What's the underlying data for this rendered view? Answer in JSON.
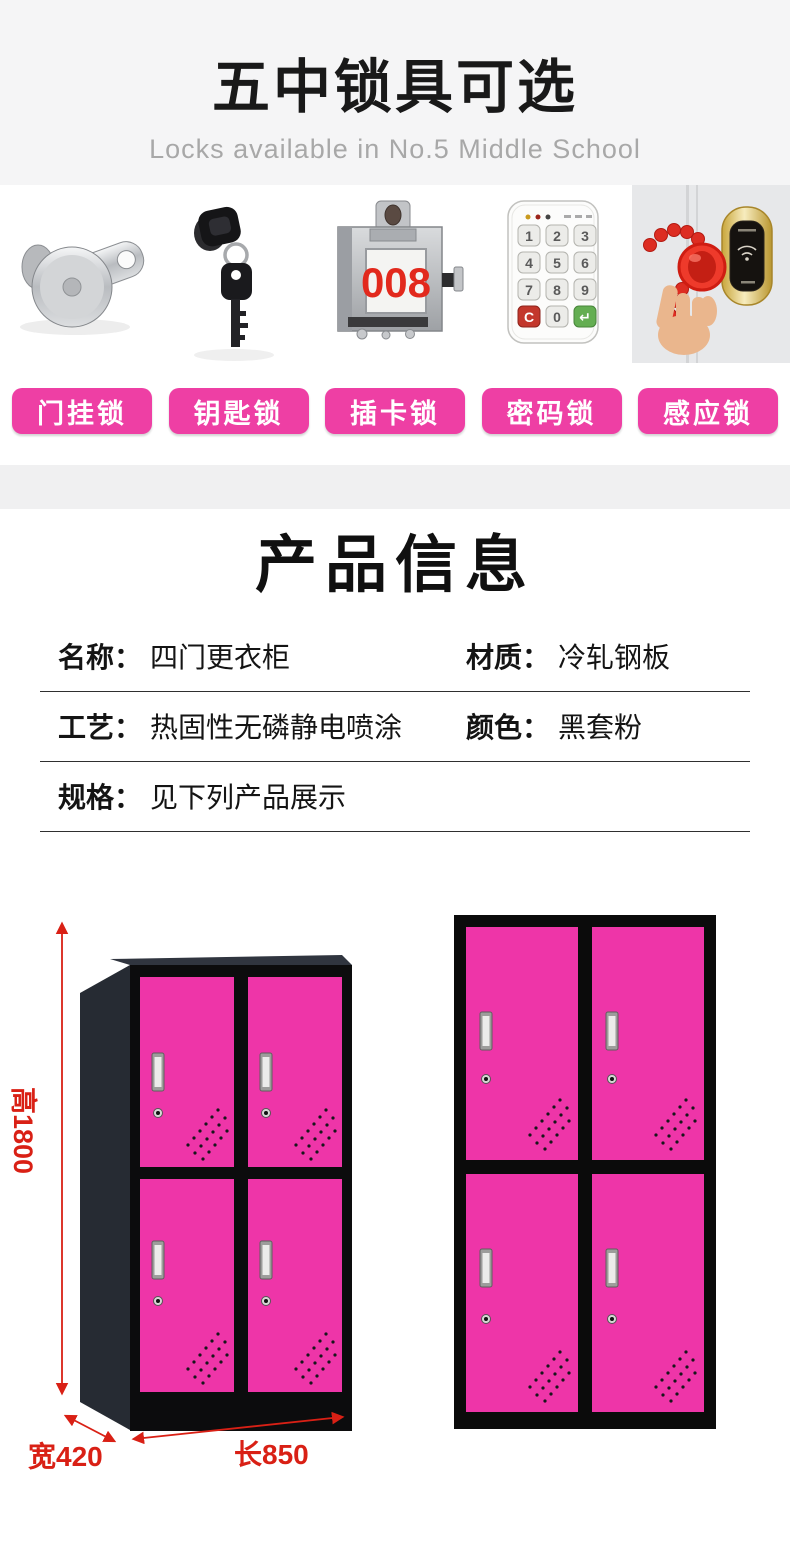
{
  "header": {
    "title": "五中锁具可选",
    "subtitle": "Locks available in No.5 Middle School"
  },
  "locks": {
    "items": [
      {
        "name": "door-hanging-lock",
        "label": "门挂锁"
      },
      {
        "name": "key-lock",
        "label": "钥匙锁"
      },
      {
        "name": "card-lock",
        "label": "插卡锁"
      },
      {
        "name": "password-lock",
        "label": "密码锁"
      },
      {
        "name": "induction-lock",
        "label": "感应锁"
      }
    ],
    "card_lock_number": "008",
    "keypad_keys": [
      "1",
      "2",
      "3",
      "4",
      "5",
      "6",
      "7",
      "8",
      "9",
      "C",
      "0",
      "↵"
    ],
    "pill_color": "#ee3fa4"
  },
  "product_info": {
    "title": "产品信息",
    "rows": [
      {
        "left_label": "名称：",
        "left_value": "四门更衣柜",
        "right_label": "材质：",
        "right_value": "冷轧钢板"
      },
      {
        "left_label": "工艺：",
        "left_value": "热固性无磷静电喷涂",
        "right_label": "颜色：",
        "right_value": "黑套粉"
      },
      {
        "left_label": "规格：",
        "left_value": "见下列产品展示",
        "right_label": "",
        "right_value": ""
      }
    ]
  },
  "display": {
    "height_label": "高1800",
    "width_label": "宽420",
    "length_label": "长850",
    "door_color": "#ee35a8",
    "frame_color": "#0c0c0d",
    "dimension_color": "#d92015"
  }
}
